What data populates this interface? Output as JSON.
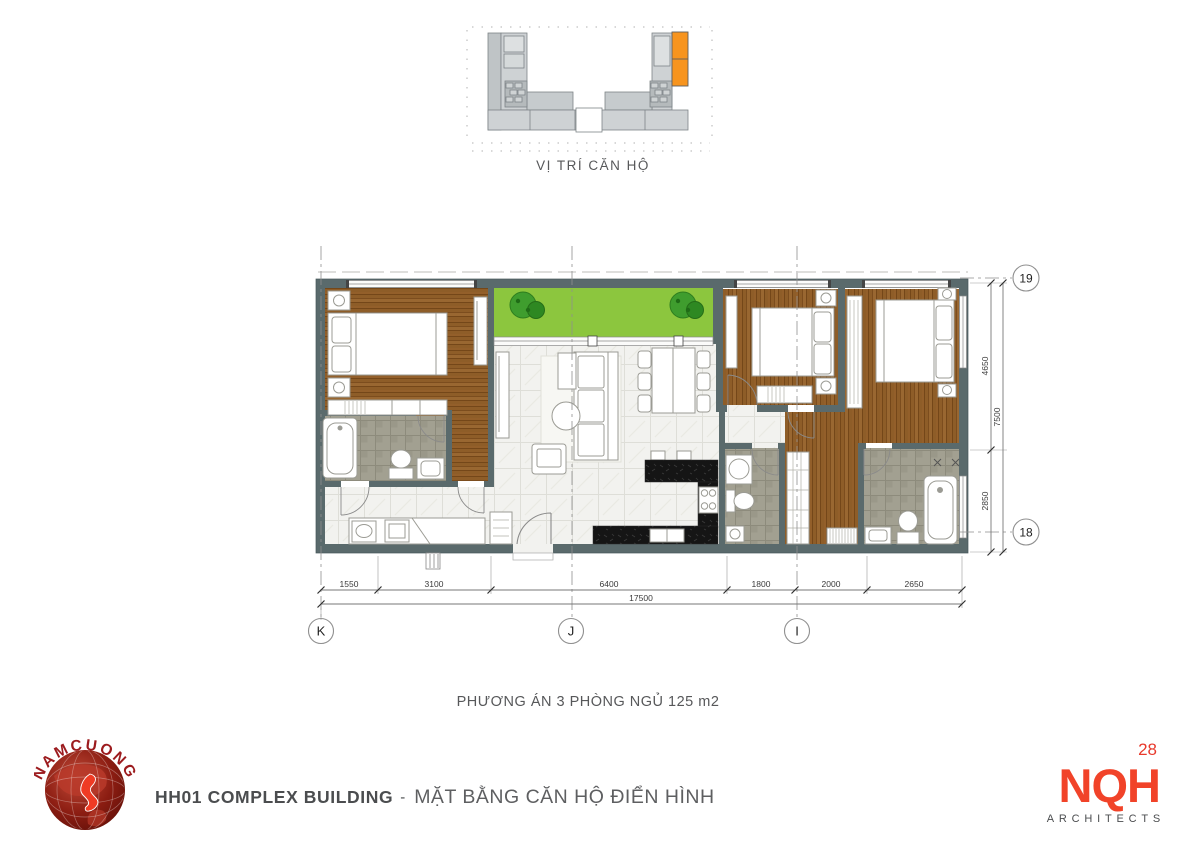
{
  "site_plan": {
    "caption": "VỊ TRÍ CĂN HỘ",
    "highlight_color": "#F7941E"
  },
  "floor_plan": {
    "caption": "PHƯƠNG ÁN 3 PHÒNG NGỦ 125 m2",
    "grid_columns": [
      "K",
      "J",
      "I"
    ],
    "grid_rows": [
      "19",
      "18"
    ],
    "dims_bottom": [
      "1550",
      "3100",
      "6400",
      "1800",
      "2000",
      "2650"
    ],
    "dim_bottom_total": "17500",
    "dims_right": [
      "4650",
      "2850"
    ],
    "dim_right_total": "7500",
    "colors": {
      "wall": "#5A6A6C",
      "wood_floor": "#8D5B26",
      "balcony": "#8CC63E",
      "kitchen_counter": "#161616"
    }
  },
  "footer": {
    "company_logo": "NAMCUONG",
    "project_title": "HH01 COMPLEX BUILDING",
    "separator": "-",
    "drawing_title": "MẶT BẰNG CĂN HỘ ĐIỂN HÌNH",
    "page_number": "28",
    "architects_logo": "NQH",
    "architects_sub": "ARCHITECTS"
  }
}
